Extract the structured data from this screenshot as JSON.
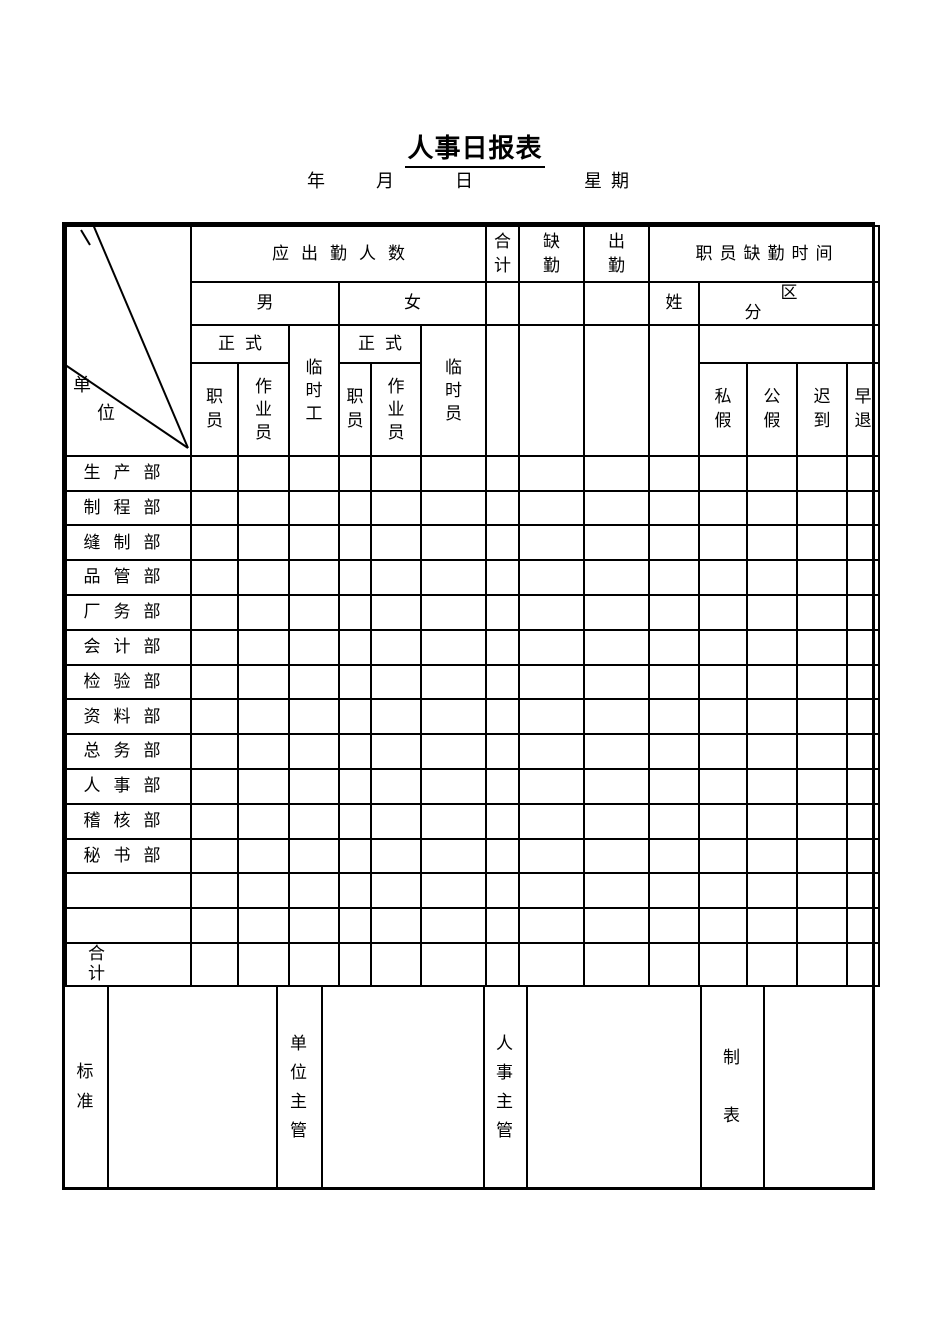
{
  "page": {
    "title": "人事日报表",
    "date_line": {
      "year": "年",
      "month": "月",
      "day": "日",
      "weekday": "星期"
    }
  },
  "table": {
    "corner": {
      "char1": "单",
      "char2": "位"
    },
    "header": {
      "required_attendance": "应出勤人数",
      "male": "男",
      "female": "女",
      "formal_male": "正式",
      "formal_female": "正式",
      "staff_male": "职员",
      "operator_male": "作业员",
      "temp_worker": "临时工",
      "staff_female": "职员",
      "operator_female": "作业员",
      "temp_staff": "临时员",
      "total": "合计",
      "absent": "缺勤",
      "present": "出勤",
      "staff_absence_time": "职员缺勤时间",
      "name": "姓",
      "category": "区分",
      "personal_leave": "私假",
      "official_leave": "公假",
      "late": "迟到",
      "early_leave": "早退"
    },
    "departments": [
      "生产部",
      "制程部",
      "缝制部",
      "品管部",
      "厂务部",
      "会计部",
      "检验部",
      "资料部",
      "总务部",
      "人事部",
      "稽核部",
      "秘书部"
    ],
    "total_row_label": "合计"
  },
  "footer": {
    "standard": "标准",
    "unit_manager": "单位主管",
    "hr_manager": "人事主管",
    "prepared_by": "制表"
  }
}
